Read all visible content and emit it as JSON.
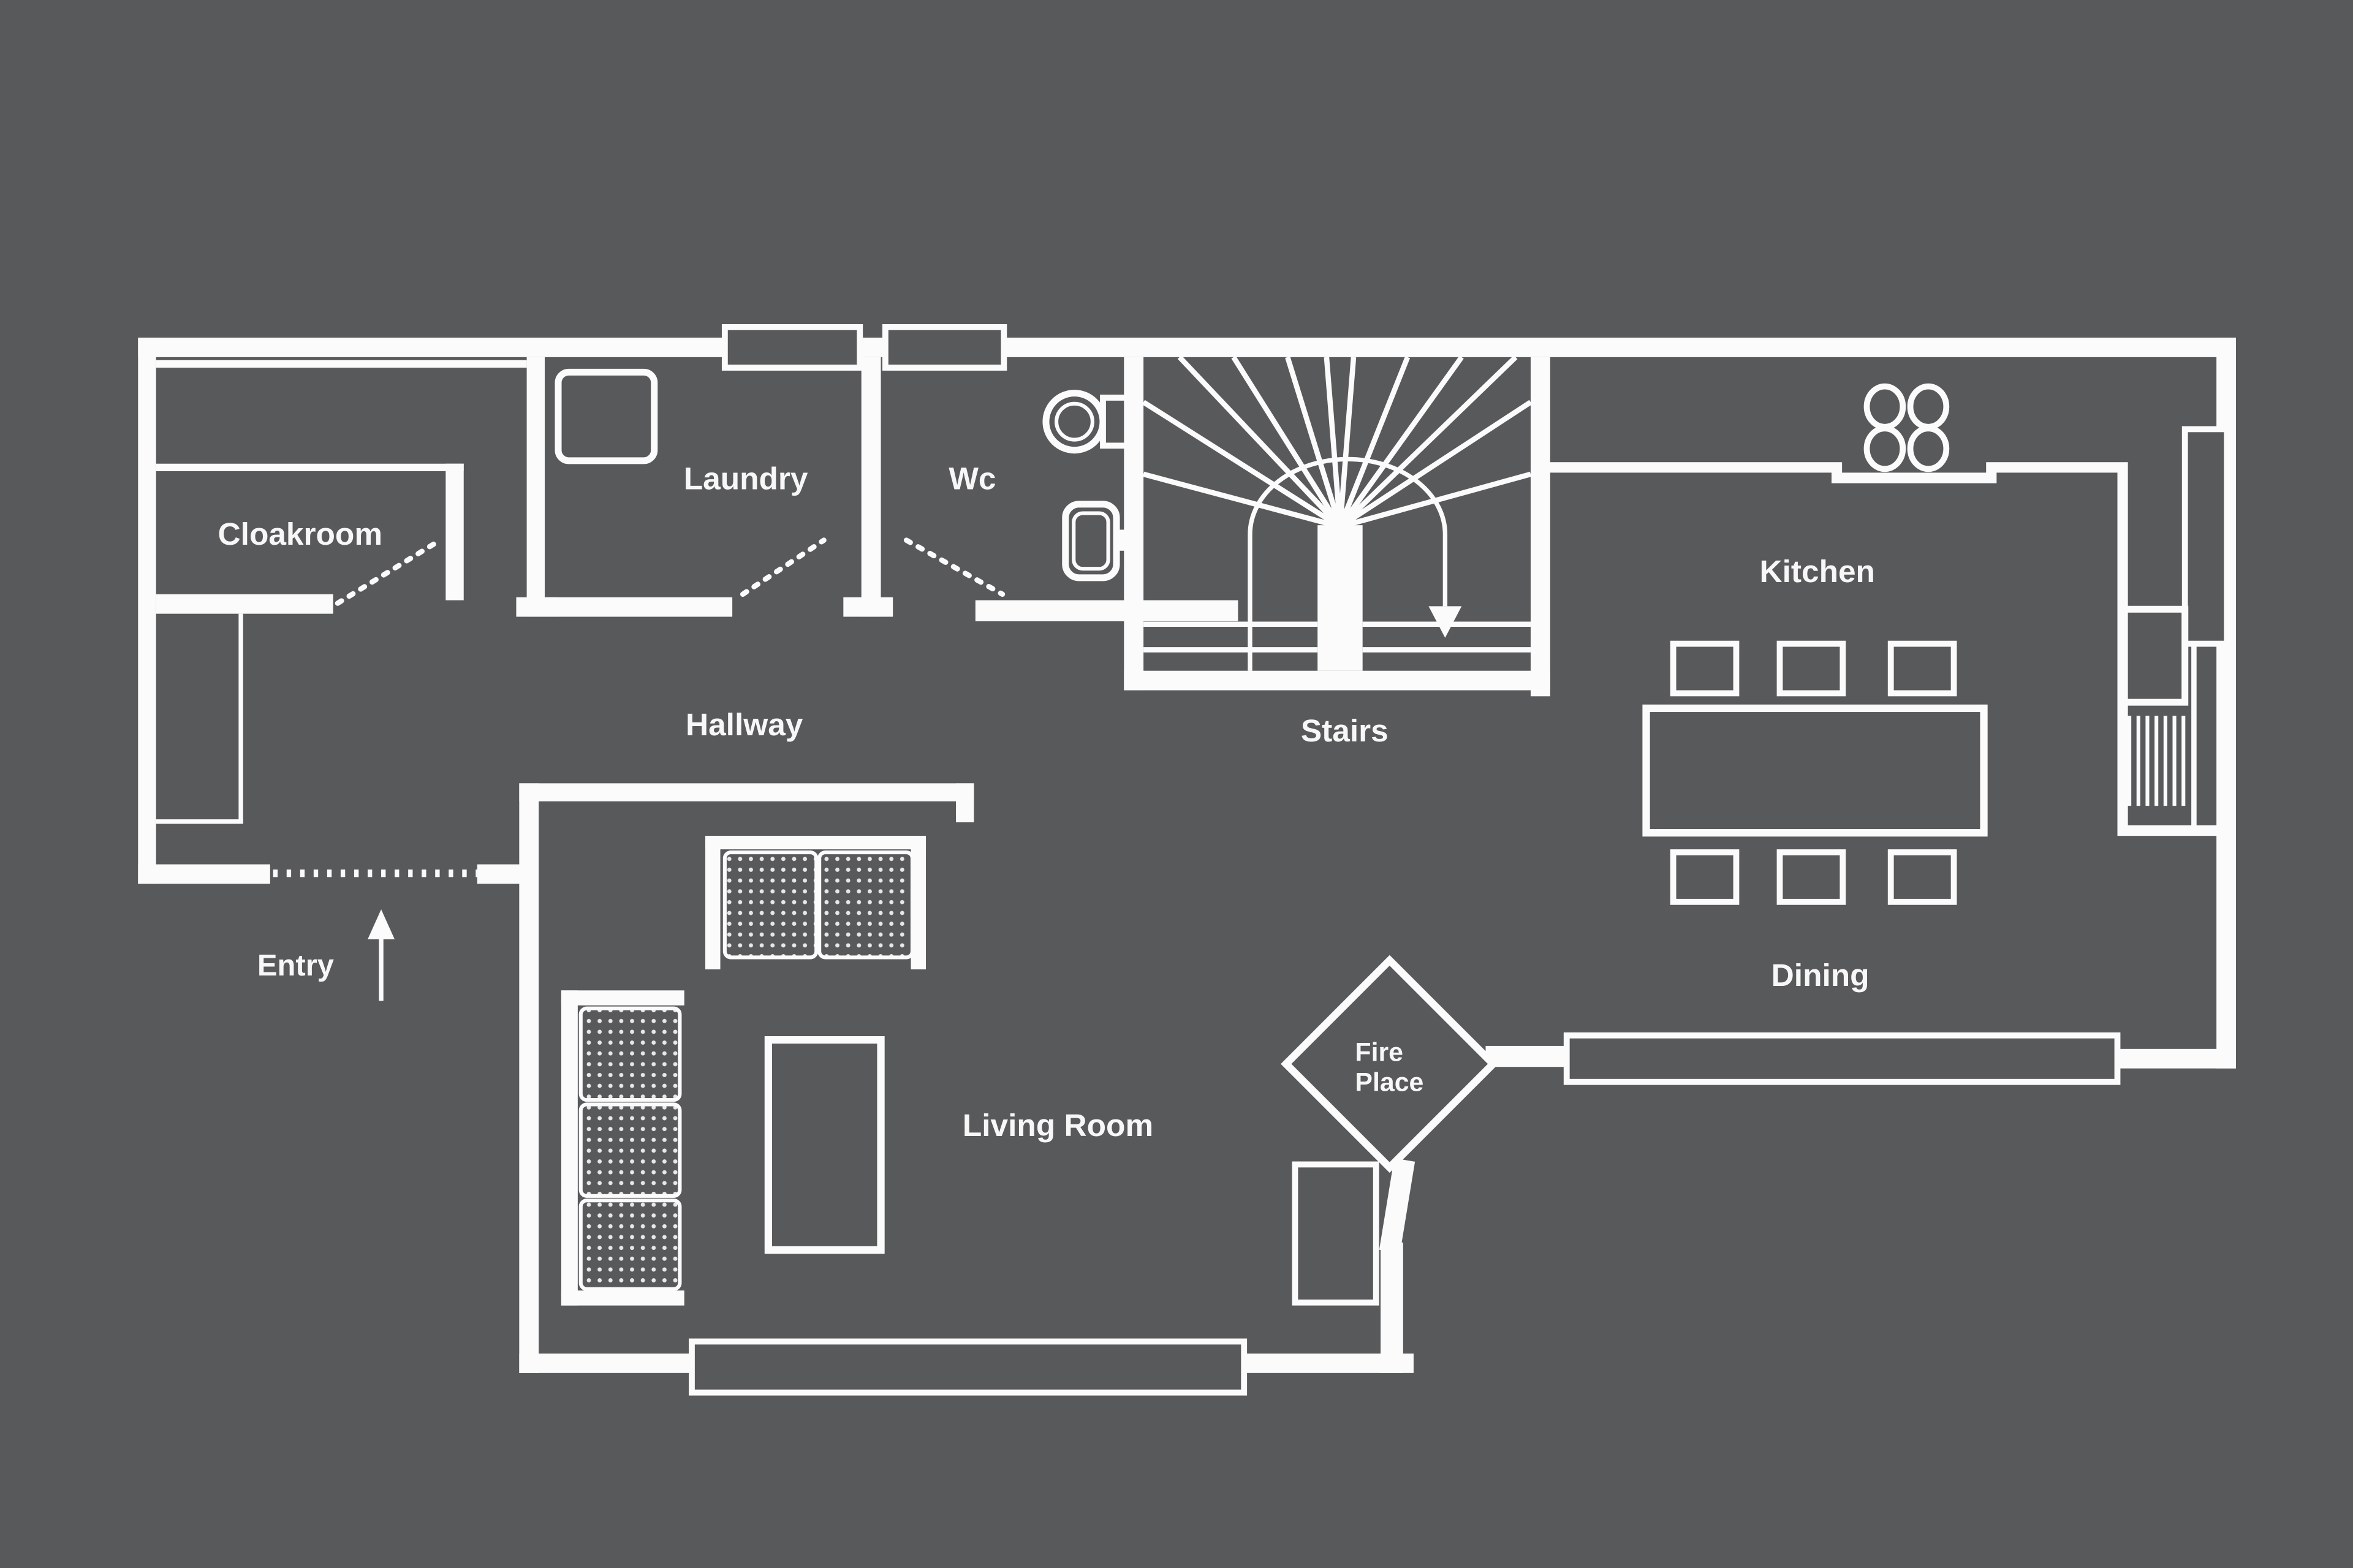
{
  "plan": {
    "labels": {
      "cloakroom": "Cloakroom",
      "laundry": "Laundry",
      "wc": "Wc",
      "stairs": "Stairs",
      "kitchen": "Kitchen",
      "hallway": "Hallway",
      "entry": "Entry",
      "living_room": "Living Room",
      "fireplace_line1": "Fire",
      "fireplace_line2": "Place",
      "dining": "Dining"
    },
    "colors": {
      "background": "#58595b",
      "line": "#fbfbfb"
    },
    "features": [
      {
        "name": "washing-machine-icon",
        "room": "Laundry"
      },
      {
        "name": "toilet-icon",
        "room": "Wc"
      },
      {
        "name": "bathroom-sink-icon",
        "room": "Wc"
      },
      {
        "name": "winder-staircase-icon",
        "room": "Stairs",
        "direction_arrow": "down"
      },
      {
        "name": "hob-icon",
        "room": "Kitchen",
        "burners": 4
      },
      {
        "name": "kitchen-sink-icon",
        "room": "Kitchen"
      },
      {
        "name": "drainer-hatch-icon",
        "room": "Kitchen"
      },
      {
        "name": "dining-table-icon",
        "room": "Dining",
        "chairs": 6
      },
      {
        "name": "loveseat-sofa-icon",
        "room": "Living Room",
        "seats": 2
      },
      {
        "name": "sofa-icon",
        "room": "Living Room",
        "seats": 3
      },
      {
        "name": "coffee-table-icon",
        "room": "Living Room"
      },
      {
        "name": "fireplace-diamond-icon",
        "room": "Living Room"
      },
      {
        "name": "log-store-icon",
        "room": "Living Room"
      },
      {
        "name": "closet-icon",
        "room": "Hallway"
      },
      {
        "name": "entry-arrow-icon",
        "room": "Entry",
        "direction": "up"
      },
      {
        "name": "door-swing-dashed-icon",
        "count": 3
      },
      {
        "name": "entry-door-dotted-icon",
        "count": 1
      },
      {
        "name": "window-icon",
        "count": 5
      }
    ]
  }
}
